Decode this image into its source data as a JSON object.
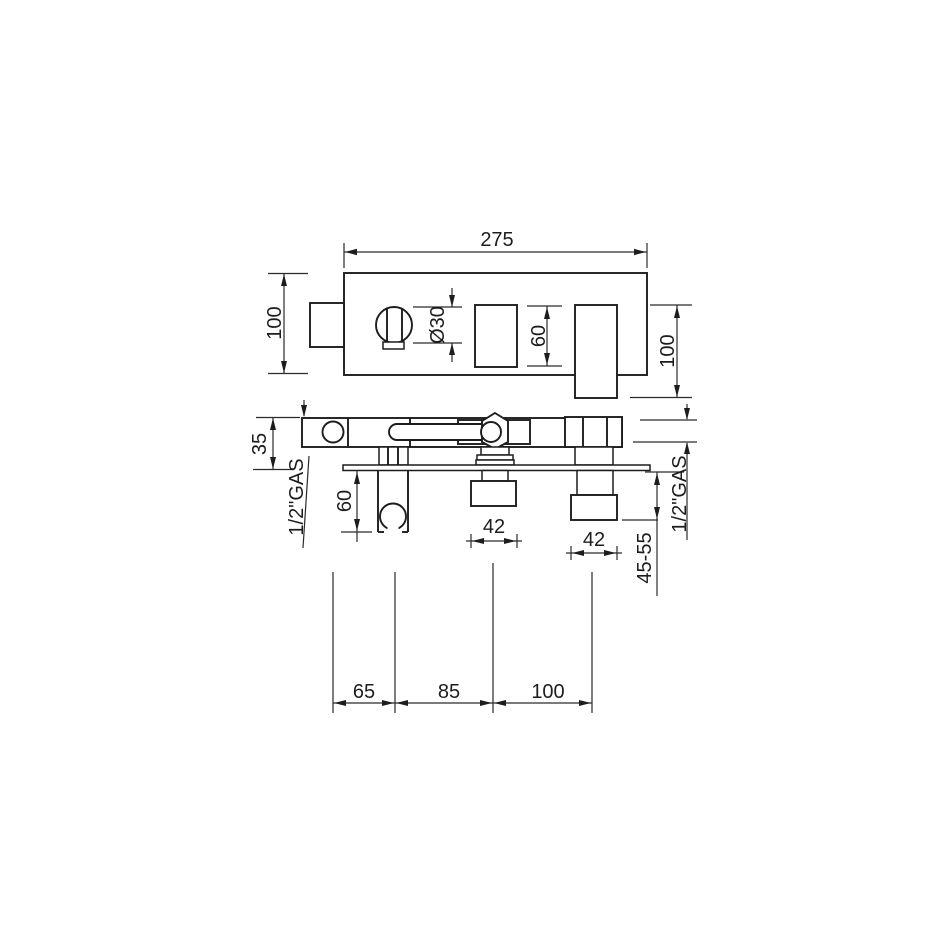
{
  "colors": {
    "background": "#ffffff",
    "line": "#1d1d1d",
    "dimension_line": "#2a2a2a",
    "text": "#1d1d1d"
  },
  "top_view": {
    "width_label": "275",
    "height_label": "100",
    "knob_diameter_label": "Ø30",
    "box_height_label": "60",
    "union_height_label": "100"
  },
  "front_view": {
    "body_height_label": "35",
    "left_thread_label": "1/2\"GAS",
    "holder_depth_label": "60",
    "spout_width_label": "42",
    "outlet_width_label": "42",
    "wall_range_label": "45-55",
    "right_thread_label": "1/2\"GAS"
  },
  "spacing": {
    "left_label": "65",
    "middle_label": "85",
    "right_label": "100"
  }
}
